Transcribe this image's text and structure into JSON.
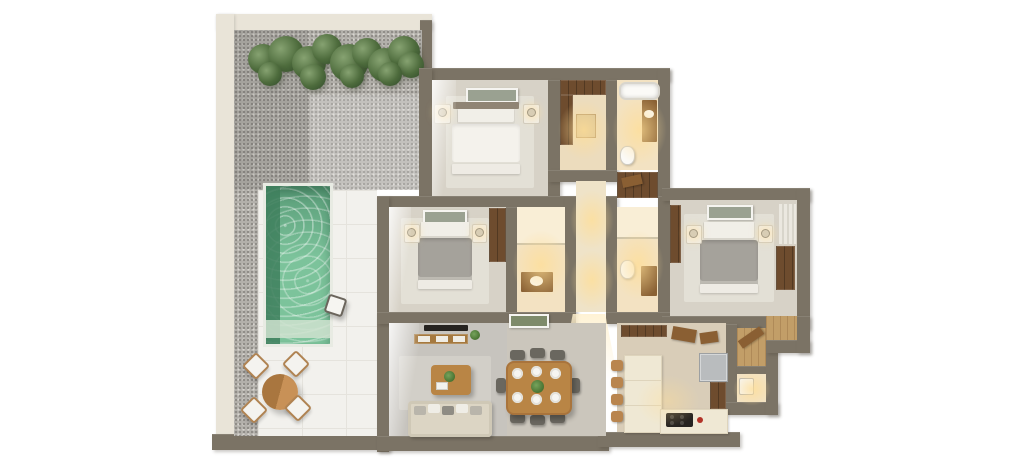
{
  "scene": {
    "title": "3D isometric apartment floor plan render with pool terrace",
    "background": "#ffffff",
    "view": "top-down dollhouse render",
    "visible_text": []
  },
  "palette": {
    "wall": "#7b7365",
    "terrace_wall": "#e9e4d8",
    "gravel": "#b3b0ab",
    "deck": "#f2f1ed",
    "pool_water": "#7cc39b",
    "pool_deep": "#3e7f5d",
    "plant_green": "#4d6b3c",
    "wood": "#b98545",
    "wood_dark": "#6e4c2e",
    "floor_bedroom": "#d7d2c7",
    "floor_warm_bath": "#f3e2c2",
    "floor_living": "#c7c4be",
    "floor_kitchen": "#d9cdb8",
    "bed_white": "#f4f2ec",
    "bed_gray": "#a5a29b",
    "sofa": "#dcd5c4",
    "counter": "#efe8d4",
    "appliance_dark": "#262320",
    "fridge": "#b9bcbe",
    "warm_glow": "#ffde96"
  },
  "rooms": [
    {
      "name": "Terrace with pool",
      "furniture": [
        "hedge plants",
        "gravel garden",
        "swimming pool",
        "sun deck",
        "round outdoor dining table",
        "4 outdoor chairs",
        "pool-side stool"
      ]
    },
    {
      "name": "Master bedroom",
      "furniture": [
        "double bed with white duvet",
        "headboard",
        "wall art",
        "2 nightstands with lamps",
        "area rug"
      ]
    },
    {
      "name": "Walk-in closet",
      "furniture": [
        "wardrobes",
        "bench"
      ]
    },
    {
      "name": "Bathroom 1",
      "furniture": [
        "bathtub",
        "wood vanity with basin",
        "toilet"
      ]
    },
    {
      "name": "Hallway",
      "furniture": [
        "linen closet",
        "ceiling lights"
      ]
    },
    {
      "name": "Bedroom 2",
      "furniture": [
        "double bed with gray duvet",
        "wall art",
        "2 nightstands with lamps",
        "wardrobe",
        "area rug"
      ]
    },
    {
      "name": "Ensuite bathroom 2",
      "furniture": [
        "shower",
        "wood vanity with basin"
      ]
    },
    {
      "name": "Bathroom 3",
      "furniture": [
        "shower",
        "toilet",
        "wood vanity"
      ]
    },
    {
      "name": "Bedroom 3",
      "furniture": [
        "double bed with gray duvet",
        "wall art",
        "2 nightstands with lamps",
        "wardrobe",
        "closet",
        "curtain",
        "area rug"
      ]
    },
    {
      "name": "Living room",
      "furniture": [
        "wall TV",
        "media console",
        "coffee table with plant",
        "sofa with cushions",
        "area rug"
      ]
    },
    {
      "name": "Dining area",
      "furniture": [
        "wood dining table",
        "6 place settings",
        "center plant",
        "dining chairs",
        "wall art"
      ]
    },
    {
      "name": "Kitchen",
      "furniture": [
        "island counter with bar stools",
        "base counter",
        "cooktop",
        "fridge",
        "tall cabinet",
        "sideboard"
      ]
    },
    {
      "name": "Entrance foyer",
      "furniture": [
        "wood door"
      ]
    },
    {
      "name": "Utility room",
      "furniture": [
        "washer"
      ]
    },
    {
      "name": "Entry vestibule",
      "furniture": [
        "wood floor"
      ]
    }
  ]
}
